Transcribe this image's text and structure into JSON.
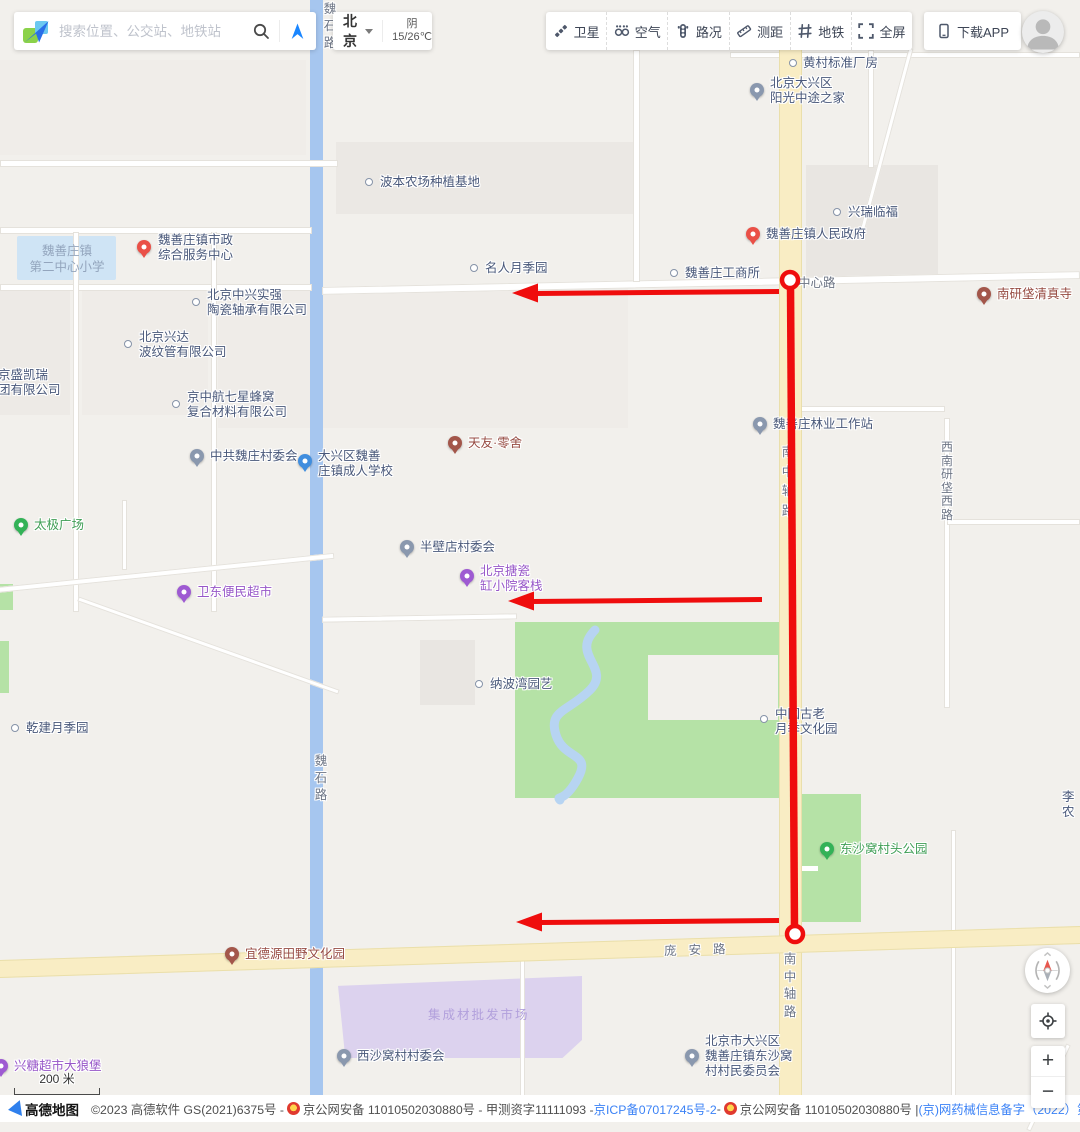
{
  "header": {
    "search": {
      "placeholder": "搜索位置、公交站、地铁站"
    },
    "city": {
      "name": "北京",
      "weather_line1": "阴",
      "weather_line2": "15/26℃"
    },
    "toolbar": [
      {
        "id": "satellite",
        "label": "卫星"
      },
      {
        "id": "air",
        "label": "空气"
      },
      {
        "id": "traffic",
        "label": "路况"
      },
      {
        "id": "measure",
        "label": "测距"
      },
      {
        "id": "metro",
        "label": "地铁"
      },
      {
        "id": "fullscreen",
        "label": "全屏"
      }
    ],
    "download_app": "下载APP"
  },
  "map": {
    "route_color": "#ef0d0d",
    "pois": [
      {
        "t": "dot",
        "mx": 793,
        "my": 63,
        "tx": 803,
        "ty": 56,
        "lines": [
          "黄村标准厂房"
        ]
      },
      {
        "t": "g",
        "mx": 757,
        "my": 90,
        "tx": 770,
        "ty": 76,
        "lines": [
          "北京大兴区",
          "阳光中途之家"
        ]
      },
      {
        "t": "dot",
        "mx": 369,
        "my": 182,
        "tx": 380,
        "ty": 175,
        "lines": [
          "波本农场种植基地"
        ]
      },
      {
        "t": "dot",
        "mx": 837,
        "my": 212,
        "tx": 848,
        "ty": 205,
        "lines": [
          "兴瑞临福"
        ]
      },
      {
        "t": "r",
        "mx": 753,
        "my": 234,
        "tx": 766,
        "ty": 227,
        "lines": [
          "魏善庄镇人民政府"
        ]
      },
      {
        "t": "dot",
        "mx": 474,
        "my": 268,
        "tx": 485,
        "ty": 261,
        "lines": [
          "名人月季园"
        ]
      },
      {
        "t": "dot",
        "mx": 674,
        "my": 273,
        "tx": 685,
        "ty": 266,
        "lines": [
          "魏善庄工商所"
        ]
      },
      {
        "t": "b",
        "mx": 984,
        "my": 294,
        "tx": 997,
        "ty": 287,
        "c": "#964a41",
        "lines": [
          "南研垡清真寺"
        ]
      },
      {
        "t": "r",
        "mx": 144,
        "my": 247,
        "tx": 158,
        "ty": 233,
        "lines": [
          "魏善庄镇市政",
          "综合服务中心"
        ]
      },
      {
        "t": "dot",
        "mx": 196,
        "my": 302,
        "tx": 207,
        "ty": 288,
        "lines": [
          "北京中兴实强",
          "陶瓷轴承有限公司"
        ]
      },
      {
        "t": "dot",
        "mx": 128,
        "my": 344,
        "tx": 139,
        "ty": 330,
        "lines": [
          "北京兴达",
          "波纹管有限公司"
        ]
      },
      {
        "t": "none",
        "mx": 0,
        "my": 368,
        "tx": -2,
        "ty": 368,
        "lines": [
          "京盛凯瑞",
          "团有限公司"
        ]
      },
      {
        "t": "dot",
        "mx": 176,
        "my": 404,
        "tx": 187,
        "ty": 390,
        "lines": [
          "京中航七星蜂窝",
          "复合材料有限公司"
        ]
      },
      {
        "t": "g",
        "mx": 197,
        "my": 456,
        "tx": 210,
        "ty": 449,
        "lines": [
          "中共魏庄村委会"
        ]
      },
      {
        "t": "bl",
        "mx": 305,
        "my": 461,
        "tx": 318,
        "ty": 449,
        "lines": [
          "大兴区魏善",
          "庄镇成人学校"
        ]
      },
      {
        "t": "b",
        "mx": 455,
        "my": 443,
        "tx": 468,
        "ty": 436,
        "c": "#964a41",
        "lines": [
          "天友·零舍"
        ]
      },
      {
        "t": "g",
        "mx": 760,
        "my": 424,
        "tx": 773,
        "ty": 417,
        "lines": [
          "魏善庄林业工作站"
        ]
      },
      {
        "t": "grn",
        "mx": 21,
        "my": 525,
        "tx": 34,
        "ty": 518,
        "c": "#3f9e55",
        "lines": [
          "太极广场"
        ]
      },
      {
        "t": "g",
        "mx": 407,
        "my": 547,
        "tx": 420,
        "ty": 540,
        "lines": [
          "半壁店村委会"
        ]
      },
      {
        "t": "p",
        "mx": 467,
        "my": 576,
        "tx": 480,
        "ty": 564,
        "c": "#9757c8",
        "lines": [
          "北京搪瓷",
          "缸小院客栈"
        ]
      },
      {
        "t": "p",
        "mx": 184,
        "my": 592,
        "tx": 197,
        "ty": 585,
        "c": "#9757c8",
        "lines": [
          "卫东便民超市"
        ]
      },
      {
        "t": "dot",
        "mx": 479,
        "my": 684,
        "tx": 490,
        "ty": 677,
        "lines": [
          "纳波湾园艺"
        ]
      },
      {
        "t": "dot",
        "mx": 764,
        "my": 719,
        "tx": 775,
        "ty": 707,
        "lines": [
          "中国古老",
          "月季文化园"
        ]
      },
      {
        "t": "dot",
        "mx": 15,
        "my": 728,
        "tx": 26,
        "ty": 721,
        "lines": [
          "乾建月季园"
        ]
      },
      {
        "t": "grn",
        "mx": 827,
        "my": 849,
        "tx": 840,
        "ty": 842,
        "c": "#3f9e55",
        "lines": [
          "东沙窝村头公园"
        ]
      },
      {
        "t": "b",
        "mx": 232,
        "my": 954,
        "tx": 245,
        "ty": 947,
        "c": "#964a41",
        "lines": [
          "宜德源田野文化园"
        ]
      },
      {
        "t": "g",
        "mx": 344,
        "my": 1056,
        "tx": 357,
        "ty": 1049,
        "lines": [
          "西沙窝村村委会"
        ]
      },
      {
        "t": "g",
        "mx": 692,
        "my": 1056,
        "tx": 705,
        "ty": 1034,
        "lines": [
          "北京市大兴区",
          "魏善庄镇东沙窝",
          "村村民委员会"
        ]
      },
      {
        "t": "p",
        "mx": 1,
        "my": 1066,
        "tx": 14,
        "ty": 1059,
        "c": "#9757c8",
        "lines": [
          "兴糖超市大狼堡"
        ]
      },
      {
        "t": "none",
        "mx": 1062,
        "my": 790,
        "tx": 1062,
        "ty": 790,
        "lines": [
          "李",
          "农"
        ]
      }
    ],
    "road_labels": [
      {
        "text": "中心路",
        "x": 798,
        "y": 272
      },
      {
        "text": "庞安路",
        "x": 664,
        "y": 939,
        "ls": 12,
        "rot": -2
      },
      {
        "text": "南中轴路",
        "x": 781,
        "y": 443,
        "v": true,
        "lh": 19.5
      },
      {
        "text": "南中轴路",
        "x": 783,
        "y": 951,
        "v": true,
        "lh": 17.5
      },
      {
        "text": "西南研垡西路",
        "x": 940,
        "y": 441,
        "v": true,
        "lh": 13.5,
        "fs": 12
      },
      {
        "text": "魏石路",
        "x": 323,
        "y": 1,
        "v": true,
        "lh": 17
      },
      {
        "text": "魏石路",
        "x": 314,
        "y": 753,
        "v": true,
        "lh": 17
      }
    ],
    "area_labels": [
      {
        "lines": [
          "魏善庄镇",
          "第二中心小学"
        ],
        "x": 67,
        "y": 243,
        "color": "#93a5bd",
        "center": true
      },
      {
        "lines": [
          "集成材批发市场"
        ],
        "x": 428,
        "y": 1007,
        "color": "#b2a0dc",
        "ls": 2
      }
    ]
  },
  "controls": {
    "zoom_in": "+",
    "zoom_out": "−"
  },
  "scale": {
    "label": "200 米"
  },
  "footer": {
    "logo_text": "高德地图",
    "parts": [
      {
        "t": "text",
        "v": "©2023 高德软件 GS(2021)6375号 - "
      },
      {
        "t": "badge"
      },
      {
        "t": "text",
        "v": "京公网安备 11010502030880号 - 甲测资字11111093 - "
      },
      {
        "t": "link",
        "v": "京ICP备07017245号-2"
      },
      {
        "t": "text",
        "v": " - "
      },
      {
        "t": "badge"
      },
      {
        "t": "text",
        "v": "京公网安备 11010502030880号 | "
      },
      {
        "t": "link",
        "v": "(京)网药械信息备字（2022）第00354号"
      },
      {
        "t": "text",
        "v": "|"
      },
      {
        "t": "link",
        "v": "资质证照"
      },
      {
        "t": "text",
        "v": " | "
      },
      {
        "t": "link",
        "v": "协议与声明"
      },
      {
        "t": "text",
        "v": " | "
      },
      {
        "t": "link",
        "v": "开"
      }
    ]
  }
}
